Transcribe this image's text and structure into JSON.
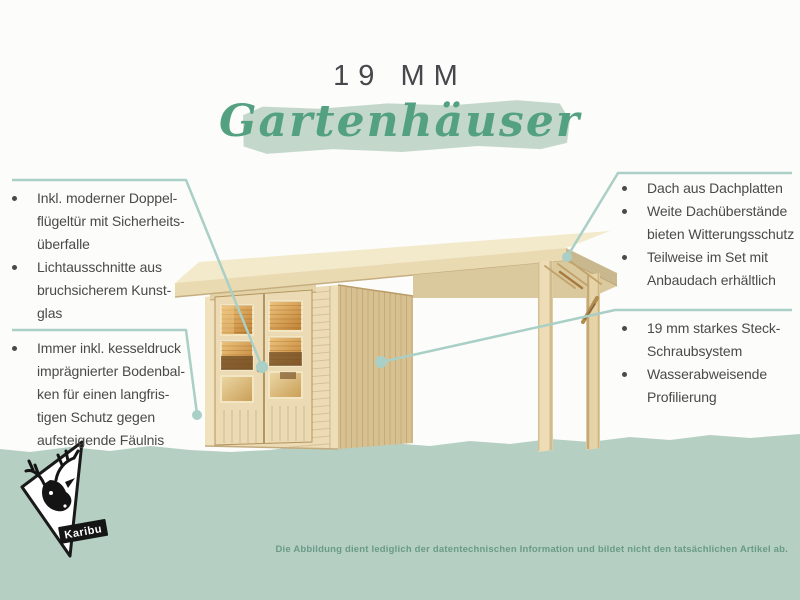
{
  "header": {
    "size_label": "19 MM",
    "title": "Gartenhäuser"
  },
  "left_features": [
    {
      "text": "Inkl. moderner Doppel-\nflügeltür mit Sicherheits-\nüberfalle"
    },
    {
      "text": "Lichtausschnitte aus\nbruchsicherem Kunst-\nglas"
    },
    {
      "text": "Immer inkl. kesseldruck\nimprägnierter Bodenbal-\nken für einen langfris-\ntigen Schutz gegen\naufsteigende Fäulnis"
    }
  ],
  "right_features_top": [
    {
      "text": "Dach aus Dachplatten"
    },
    {
      "text": "Weite Dachüberstände\nbieten Witterungsschutz"
    },
    {
      "text": "Teilweise im Set mit\nAnbaudach erhältlich"
    }
  ],
  "right_features_bottom": [
    {
      "text": "19 mm starkes Steck-\nSchraubsystem"
    },
    {
      "text": "Wasserabweisende\nProfilierung"
    }
  ],
  "footer": {
    "brand": "Karibu",
    "disclaimer": "Die Abbildung dient lediglich der datentechnischen Information und bildet nicht den tatsächlichen Artikel ab."
  },
  "colors": {
    "accent_script_green": "#54a182",
    "brush_highlight": "#c3d8cb",
    "callout_teal": "#a9cfc6",
    "ground_band": "#b5cfc3",
    "body_text": "#4a4a4a",
    "disclaimer_text": "#699b86",
    "wood_facade": "#ecdbb4",
    "wood_side_wall": "#d8c190",
    "wood_roof": "#f3eacb",
    "window_amber": "#bf8033"
  }
}
